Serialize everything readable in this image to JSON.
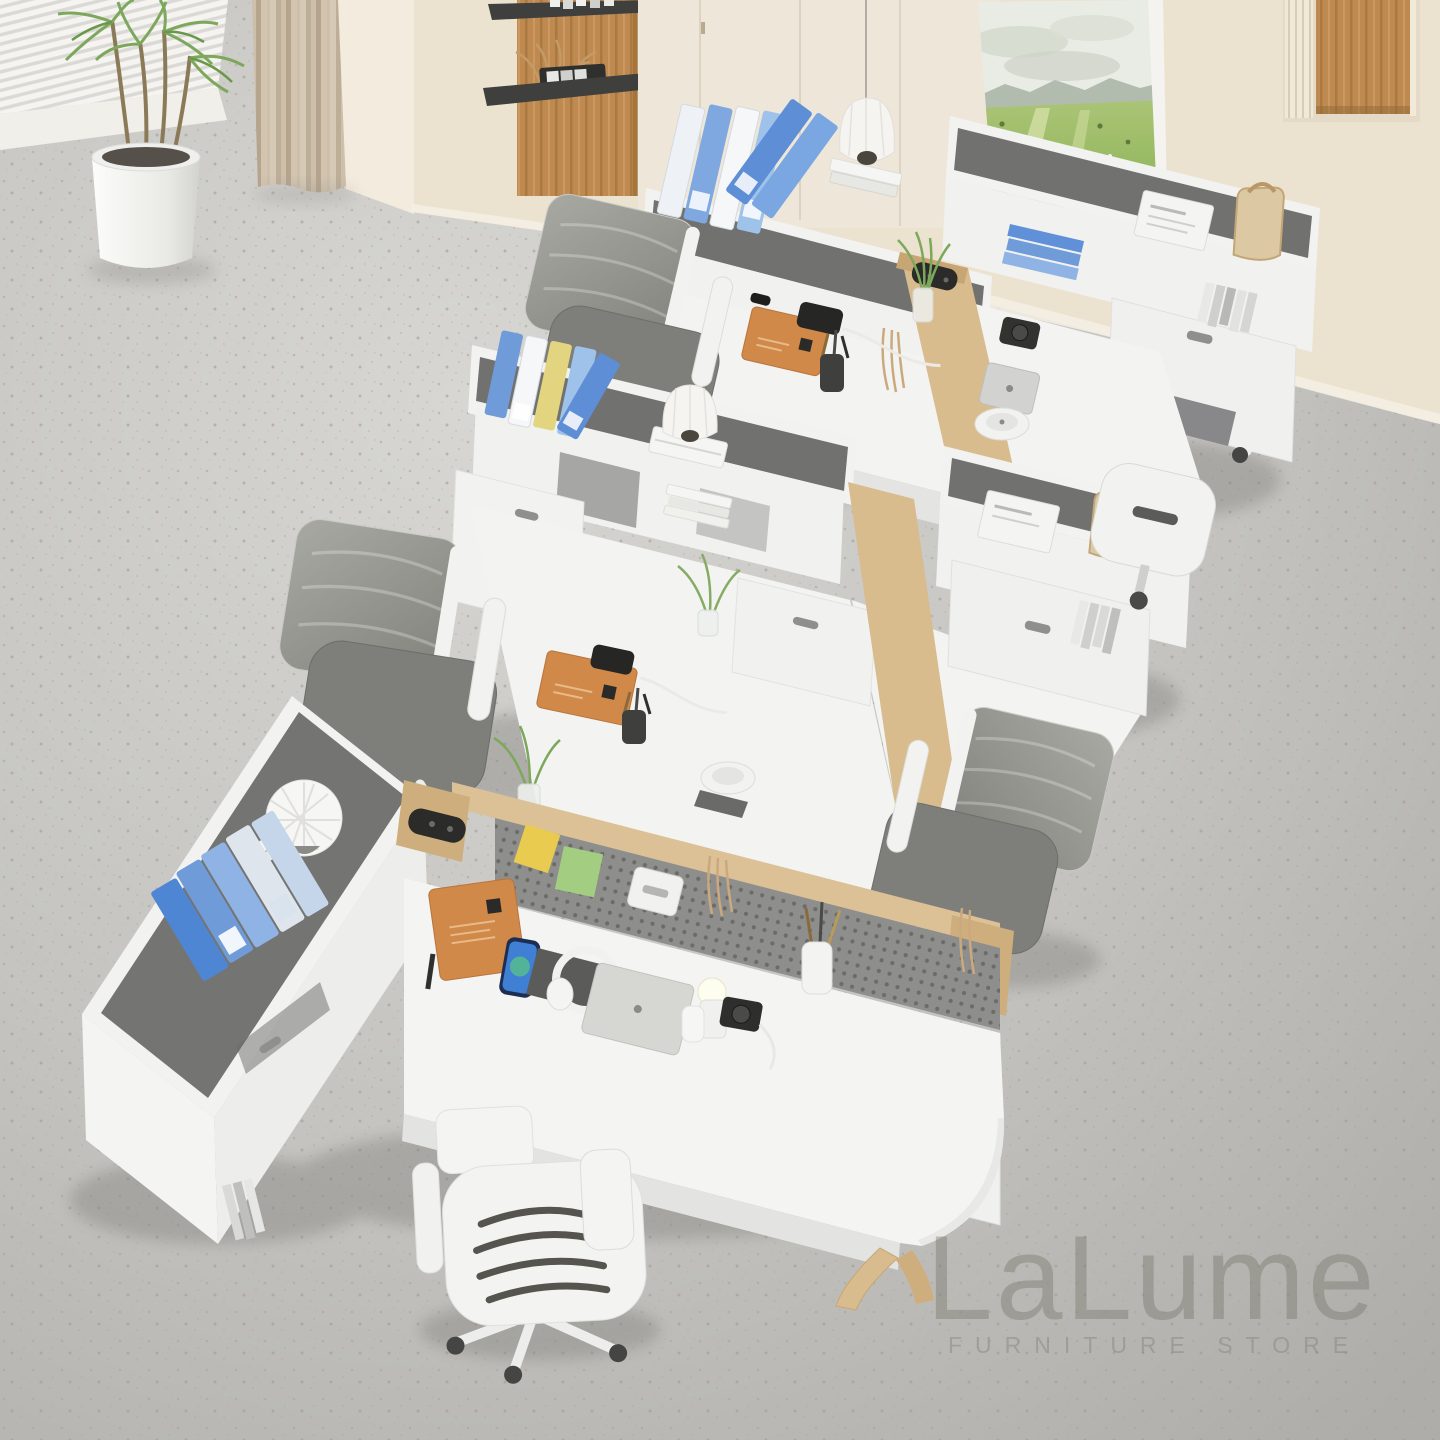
{
  "watermark": {
    "brand": "LaLume",
    "tagline": "FURNITURE STORE"
  },
  "palette": {
    "floor": "#c6c5c1",
    "wall": "#eee5d4",
    "curtain": "#c9bba6",
    "wood_panel": "#bf8a52",
    "oak_trim": "#dcc096",
    "desk_white": "#f3f3f1",
    "desktop_inlay": "#71716f",
    "pegboard": "#8d8d8b",
    "chair_mesh": "#96968f",
    "binder_blue": "#5f90d8",
    "binder_light_blue": "#9fc2ea",
    "binder_yellow": "#e3d57f",
    "notebook_orange": "#d08948",
    "plant_green": "#7da85c",
    "sticky_yellow": "#e9cb50",
    "sticky_green": "#a3cd80",
    "painting_field": "#9fc06a"
  },
  "scene": {
    "subject": "modular six-seat office workstation set, overhead showroom view",
    "room": {
      "floor": "light gray terrazzo",
      "back_wall": "cream panel wall",
      "window_blinds": "white blinds, upper left",
      "curtain": "beige floor-length curtain",
      "potted_plant": "dracaena in white cylinder planter",
      "wall_shelves": "oak panel with two black floating shelves and dried decor",
      "pendant_lamp": "white pleated dome pendant",
      "wall_art": "green landscape painting leaning on hutch",
      "wall_niche": "recessed niche with oak back and slat trim"
    },
    "product": {
      "materials": [
        "white laminate",
        "graphite felt inlay",
        "light oak trim"
      ],
      "features": [
        "overhead hutch shelves",
        "storage drawers",
        "perforated privacy screen",
        "built-in power modules",
        "cable grommets"
      ]
    },
    "chairs": {
      "count": 6,
      "type": "white-frame mesh task chairs on casters"
    },
    "desk_items": [
      "ring binders",
      "leather notebooks",
      "smartphone",
      "laptop",
      "headphones",
      "dome desk lamps",
      "pen cups",
      "green sprigs in vases",
      "magazines",
      "tote bags",
      "camera",
      "tablet",
      "sticky notes",
      "shell ornament"
    ]
  }
}
